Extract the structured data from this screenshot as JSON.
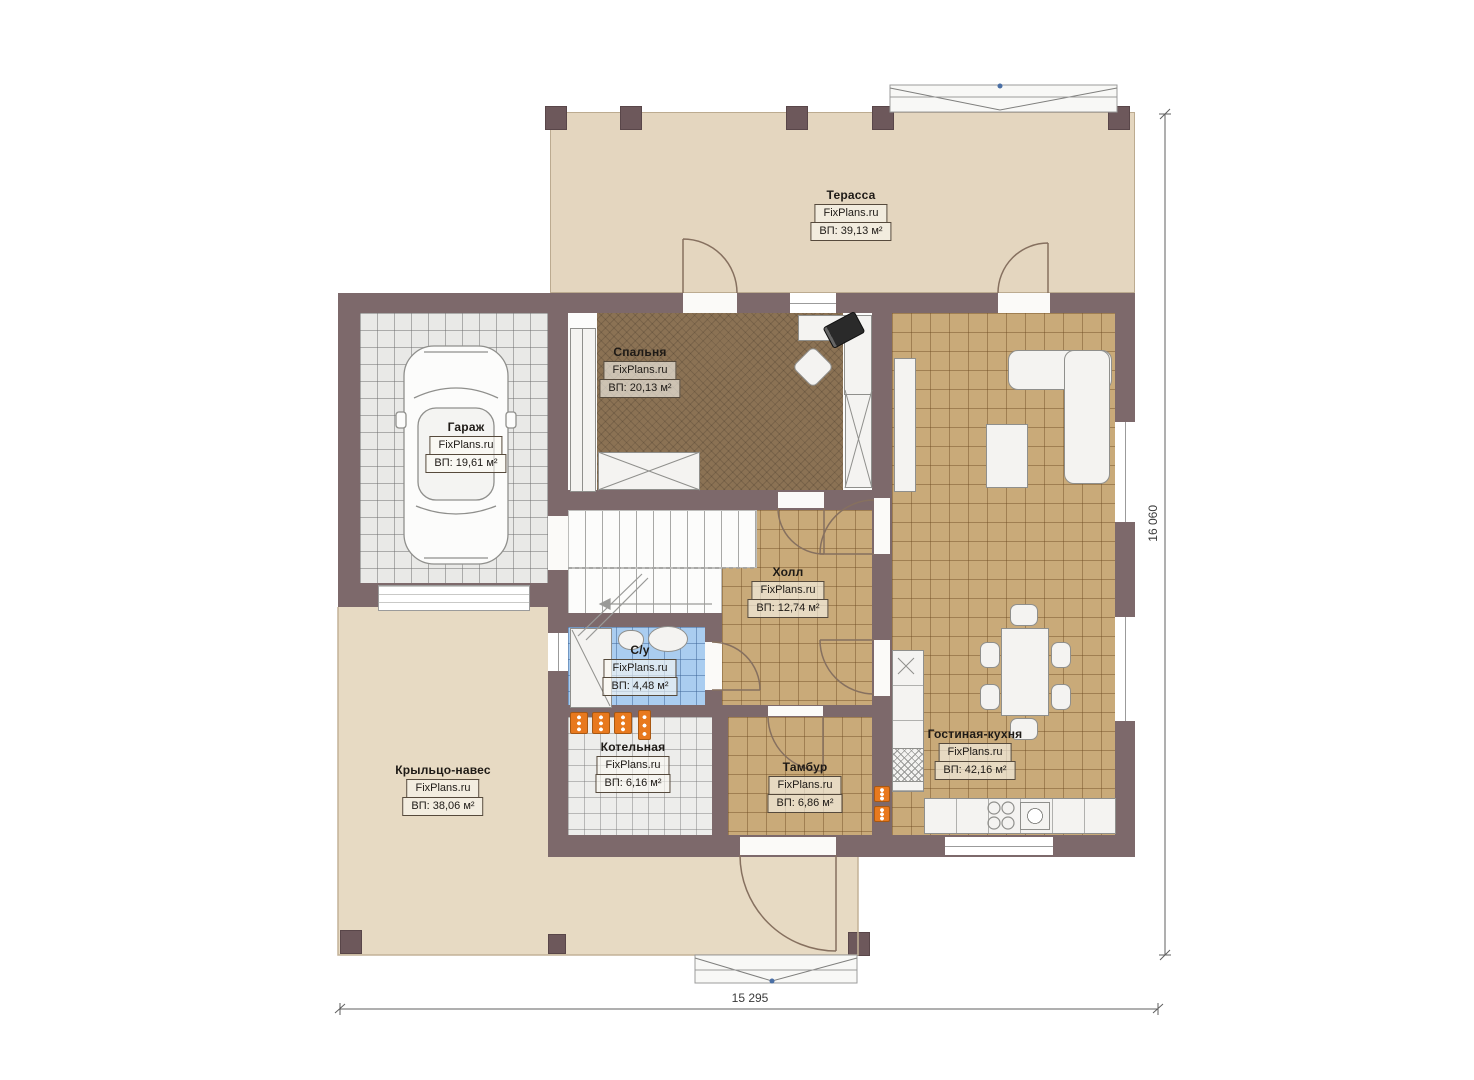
{
  "plan": {
    "watermark": "FixPlans.ru"
  },
  "rooms": {
    "terrace": {
      "name": "Терасса",
      "brand": "FixPlans.ru",
      "area": "ВП: 39,13 м²"
    },
    "bedroom": {
      "name": "Спальня",
      "brand": "FixPlans.ru",
      "area": "ВП: 20,13 м²"
    },
    "garage": {
      "name": "Гараж",
      "brand": "FixPlans.ru",
      "area": "ВП: 19,61 м²"
    },
    "hall": {
      "name": "Холл",
      "brand": "FixPlans.ru",
      "area": "ВП: 12,74 м²"
    },
    "bathroom": {
      "name": "С/у",
      "brand": "FixPlans.ru",
      "area": "ВП: 4,48 м²"
    },
    "boiler": {
      "name": "Котельная",
      "brand": "FixPlans.ru",
      "area": "ВП: 6,16 м²"
    },
    "vestibule": {
      "name": "Тамбур",
      "brand": "FixPlans.ru",
      "area": "ВП: 6,86 м²"
    },
    "living_kitchen": {
      "name": "Гостиная-кухня",
      "brand": "FixPlans.ru",
      "area": "ВП: 42,16 м²"
    },
    "porch": {
      "name": "Крыльцо-навес",
      "brand": "FixPlans.ru",
      "area": "ВП: 38,06 м²"
    }
  },
  "dimensions": {
    "bottom": "15 295",
    "right": "16 060"
  },
  "colors": {
    "wall": "#7d696b",
    "terrace_floor": "#e4d6bf",
    "tile_floor": "#c9aa79",
    "bath_floor": "#aacdf0",
    "carpet": "#8b7254",
    "radiator": "#e8791e"
  }
}
